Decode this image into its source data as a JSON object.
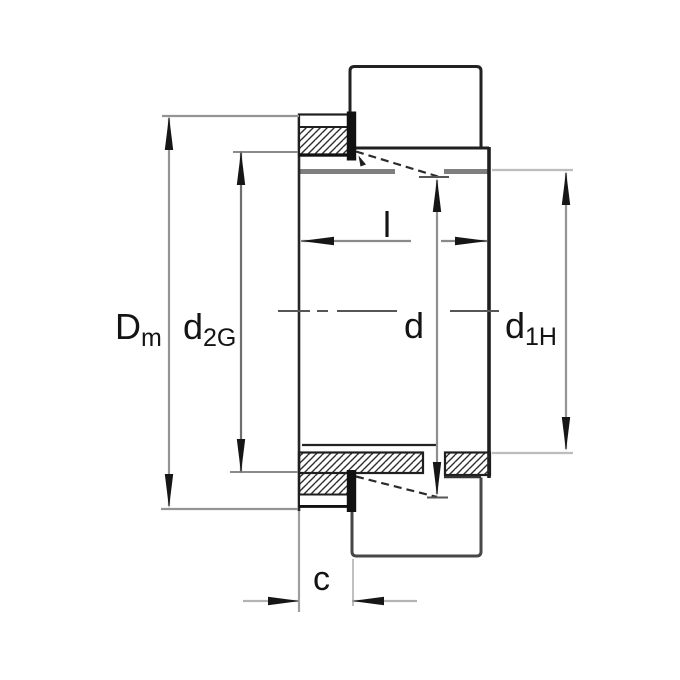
{
  "figure": {
    "title": "Adapter sleeve sectional drawing",
    "background": "#ffffff"
  },
  "colors": {
    "object_line": "#1f1f1f",
    "surface_gray": "#7f7f7f",
    "dimension_line": "#8f8f8f",
    "extension_light": "#bdbdbd",
    "arrow": "#161616",
    "center_line": "#565656"
  },
  "dimensions": {
    "Dm": {
      "main": "D",
      "sub": "m"
    },
    "d2G": {
      "main": "d",
      "sub": "2G"
    },
    "l": {
      "main": "l"
    },
    "d": {
      "main": "d"
    },
    "d1H": {
      "main": "d",
      "sub": "1H"
    },
    "c": {
      "main": "c"
    }
  }
}
